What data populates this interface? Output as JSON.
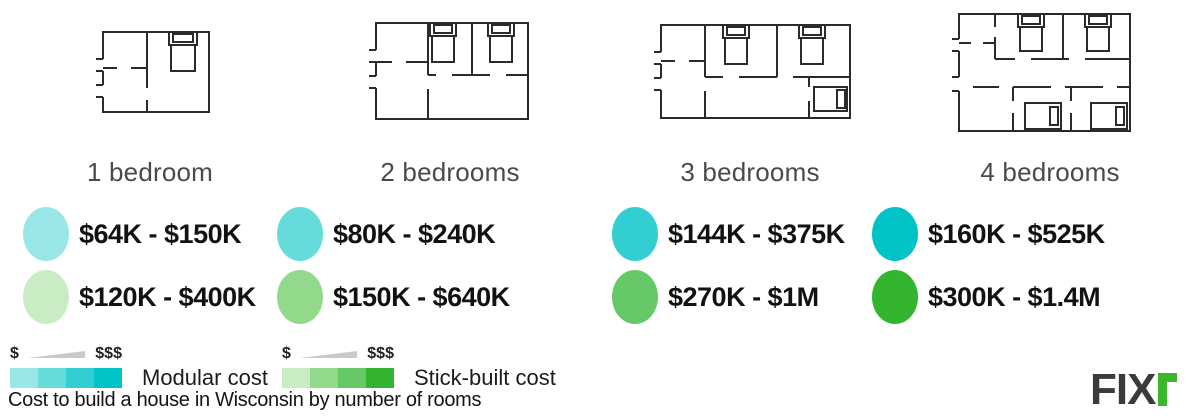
{
  "title_caption": "Cost to build a house in Wisconsin by number of rooms",
  "columns": [
    {
      "label": "1 bedroom",
      "modular_range": "$64K - $150K",
      "modular_color": "#99e6e6",
      "stick_range": "$120K - $400K",
      "stick_color": "#c9ecc4"
    },
    {
      "label": "2 bedrooms",
      "modular_range": "$80K - $240K",
      "modular_color": "#66dbdb",
      "stick_range": "$150K - $640K",
      "stick_color": "#92d98c"
    },
    {
      "label": "3 bedrooms",
      "modular_range": "$144K - $375K",
      "modular_color": "#33ced1",
      "stick_range": "$270K - $1M",
      "stick_color": "#66c967"
    },
    {
      "label": "4 bedrooms",
      "modular_range": "$160K - $525K",
      "modular_color": "#00c2c7",
      "stick_range": "$300K - $1.4M",
      "stick_color": "#33b530"
    }
  ],
  "legend": {
    "low_symbol": "$",
    "high_symbol": "$$$",
    "modular_label": "Modular cost",
    "stick_label": "Stick-built cost",
    "modular_scale": [
      "#99e6e6",
      "#66dbdb",
      "#33ced1",
      "#00c2c7"
    ],
    "stick_scale": [
      "#c9ecc4",
      "#92d98c",
      "#66c967",
      "#33b530"
    ],
    "wedge_color": "#c9c9c9"
  },
  "logo": {
    "text": "FIX",
    "dark_color": "#3b3b3d",
    "green_color": "#3cb72d"
  },
  "chart_data": {
    "type": "table",
    "title": "Cost to build a house in Wisconsin by number of rooms",
    "categories": [
      "1 bedroom",
      "2 bedrooms",
      "3 bedrooms",
      "4 bedrooms"
    ],
    "series": [
      {
        "name": "Modular cost",
        "range_labels": [
          "$64K - $150K",
          "$80K - $240K",
          "$144K - $375K",
          "$160K - $525K"
        ],
        "range_min_usd": [
          64000,
          80000,
          144000,
          160000
        ],
        "range_max_usd": [
          150000,
          240000,
          375000,
          525000
        ]
      },
      {
        "name": "Stick-built cost",
        "range_labels": [
          "$120K - $400K",
          "$150K - $640K",
          "$270K - $1M",
          "$300K - $1.4M"
        ],
        "range_min_usd": [
          120000,
          150000,
          270000,
          300000
        ],
        "range_max_usd": [
          400000,
          640000,
          1000000,
          1400000
        ]
      }
    ],
    "legend_position": "bottom-left",
    "color_meaning": "darker shade = more bedrooms / higher cost"
  }
}
